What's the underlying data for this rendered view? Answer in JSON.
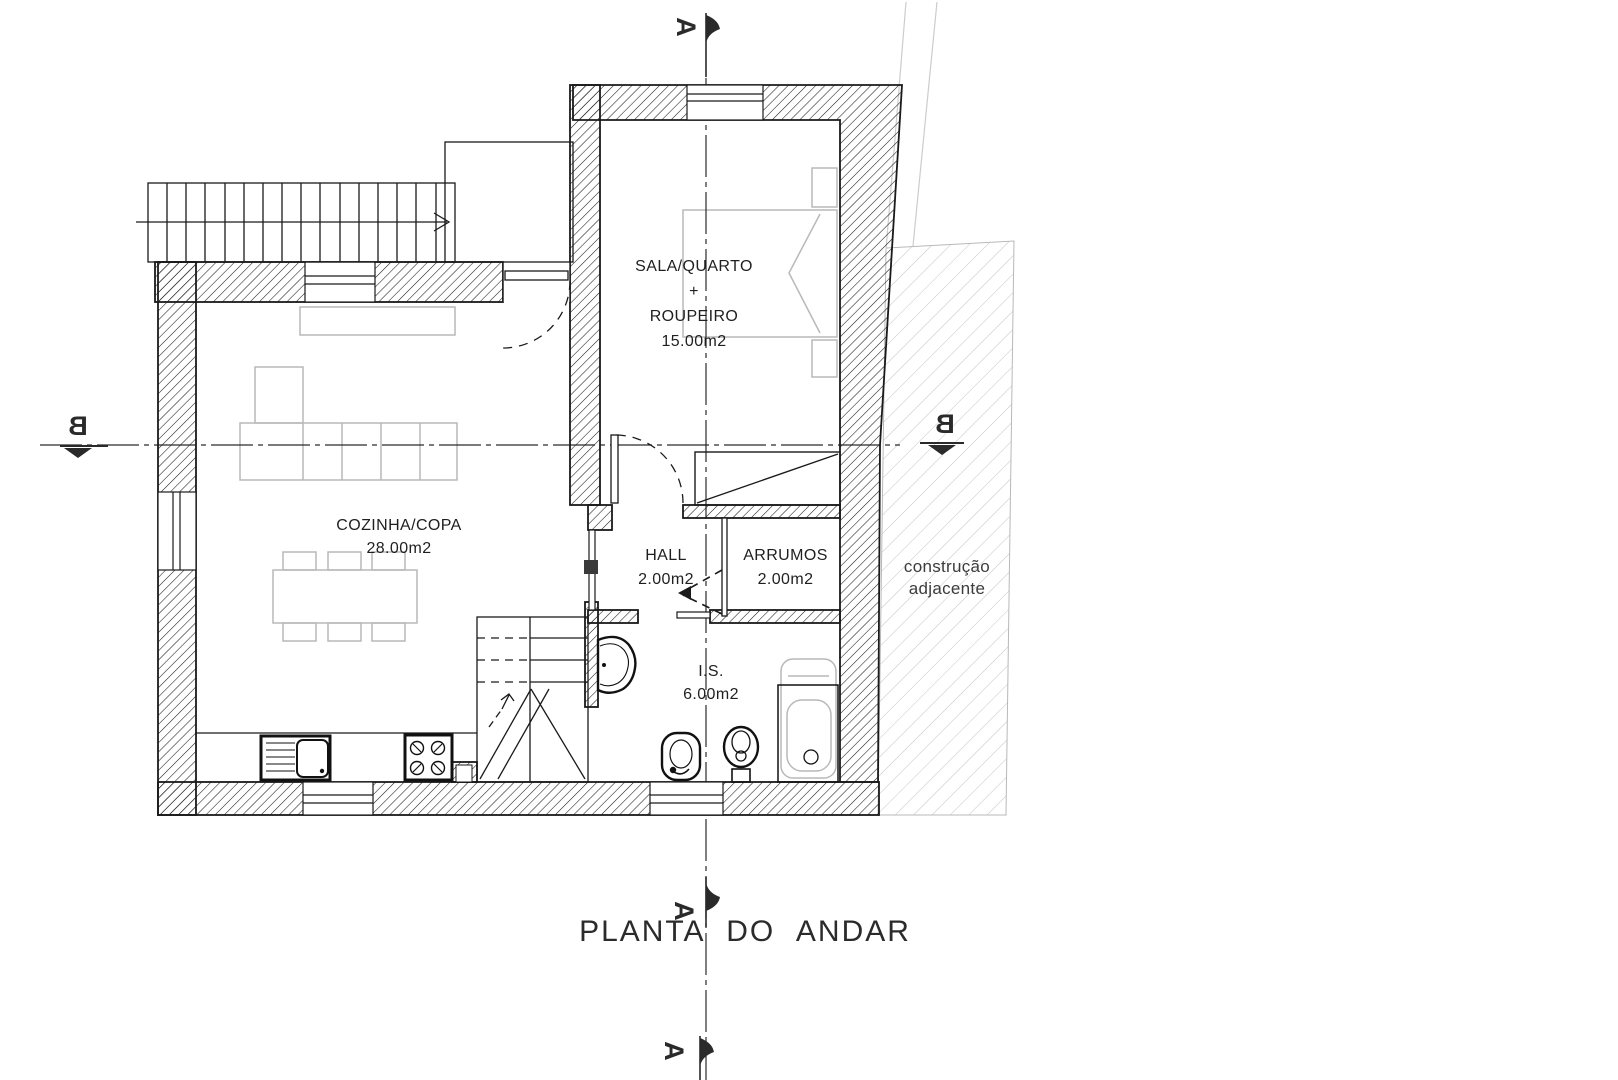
{
  "title": "PLANTA DO ANDAR",
  "rooms": [
    {
      "id": "bedroom",
      "lines": [
        "SALA/QUARTO",
        "+",
        "ROUPEIRO"
      ],
      "area": "15.00m2"
    },
    {
      "id": "kitchen",
      "lines": [
        "COZINHA/COPA"
      ],
      "area": "28.00m2"
    },
    {
      "id": "hall",
      "lines": [
        "HALL"
      ],
      "area": "2.00m2"
    },
    {
      "id": "storage",
      "lines": [
        "ARRUMOS"
      ],
      "area": "2.00m2"
    },
    {
      "id": "bathroom",
      "lines": [
        "I.S."
      ],
      "area": "6.00m2"
    }
  ],
  "annotations": {
    "adjacent_line1": "construção",
    "adjacent_line2": "adjacente"
  },
  "section_markers": {
    "a": "A",
    "b": "B"
  },
  "colors": {
    "ink": "#1a1a1a",
    "faint_furniture": "#b9b9b9",
    "light_hatch": "#c3c3c3",
    "paper": "#ffffff"
  }
}
